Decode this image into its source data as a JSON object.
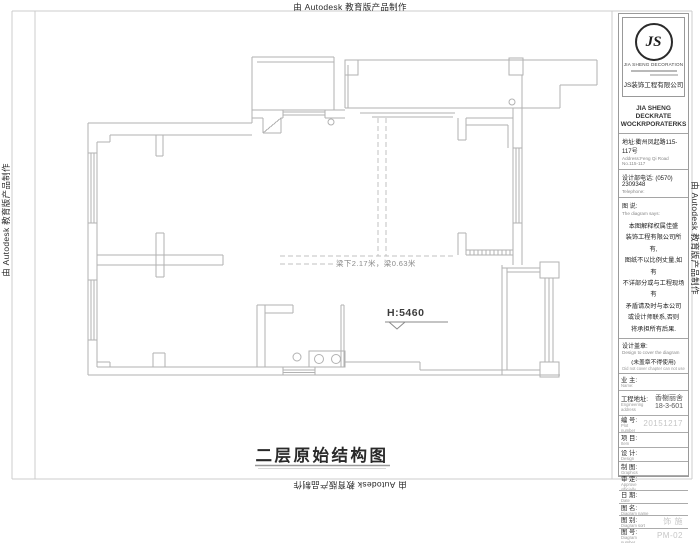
{
  "watermark": "由 Autodesk 教育版产品制作",
  "plan": {
    "beam_note": "梁下2.17米，梁0.63米",
    "height_label": "H:5460",
    "title": "二层原始结构图"
  },
  "title_block": {
    "logo_monogram": "JS",
    "logo_sub": "JIA SHENG DECORATION",
    "company_cn": "JS装饰工程有限公司",
    "company_en_line1": "JIA SHENG DECKRATE",
    "company_en_line2": "WOCKRPORATERKS",
    "address_cn": "地址:衢州凤起路115-117号",
    "address_en": "Address:Feng Qi Road No.115-117",
    "phone_cn": "设计部电话: (0570) 2309348",
    "phone_en": "Telephone:",
    "notes_title_cn": "图 说:",
    "notes_title_en": "The diagram says:",
    "notes_line1": "本图解释权属佳盛",
    "notes_line2": "装饰工程有限公司所有,",
    "notes_line3": "图纸不以比例丈量,如有",
    "notes_line4": "不详部分或与工程现场有",
    "notes_line5": "矛盾请及时与本公司",
    "notes_line6": "或设计师联系,否则",
    "notes_line7": "将承担所有后果.",
    "stamp_label_cn": "设计盖章:",
    "stamp_label_en": "Design to cover the diagram",
    "stamp_warning_cn": "(未盖章不得使用)",
    "stamp_warning_en": "Did not cover chapter can not use",
    "rows": [
      {
        "label": "业 主:",
        "sub": "Name:",
        "value": ""
      },
      {
        "label": "工程地址:",
        "sub": "Engineering address",
        "value1": "香榭丽舍",
        "value2": "18-3-601"
      },
      {
        "label": "编 号:",
        "sub": "Plot number",
        "value": "20151217"
      },
      {
        "label": "项 目:",
        "sub": "Item",
        "value": ""
      },
      {
        "label": "设 计:",
        "sub": "Design",
        "value": ""
      },
      {
        "label": "制 图:",
        "sub": "Graphics",
        "value": ""
      },
      {
        "label": "审 定:",
        "sub": "Approve officially",
        "value": ""
      },
      {
        "label": "日 期:",
        "sub": "Date",
        "value": ""
      },
      {
        "label": "图 名:",
        "sub": "Diagram name",
        "value": ""
      },
      {
        "label": "图 别:",
        "sub": "Diagram sort",
        "value": "饰 施"
      },
      {
        "label": "图 号:",
        "sub": "Diagram number",
        "value": "PM-02"
      }
    ]
  },
  "colors": {
    "wall_line": "#b2b2b2",
    "frame_line": "#cccccc",
    "dashed_beam": "#c0c0c0",
    "text_dark": "#2a2a2a",
    "value_gray": "#c6c6c6"
  }
}
